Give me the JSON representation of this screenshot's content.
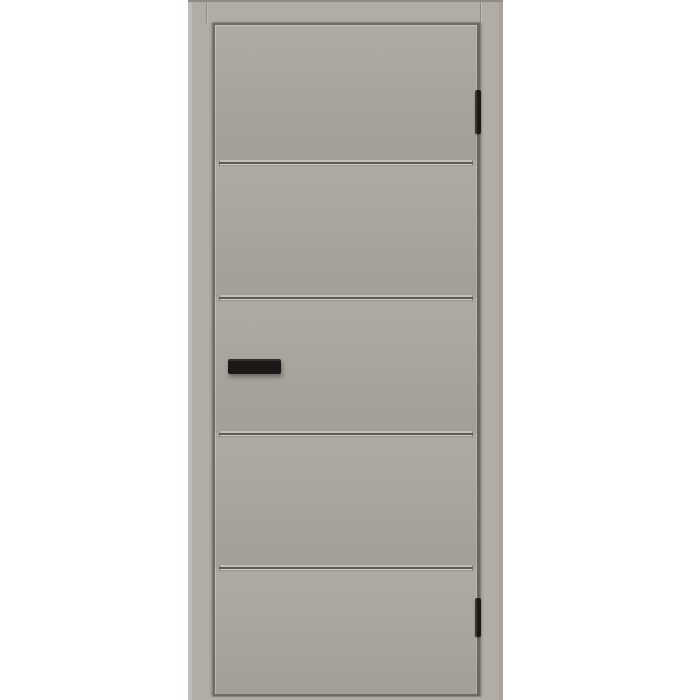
{
  "scene": {
    "description": "Product image of a gray interior door with frame, five flat panels separated by four horizontal grooves, black bar handle on the left stile and two black hinges on the right edge",
    "background_color": "#ffffff"
  },
  "door": {
    "panel_count": 5,
    "groove_count": 4,
    "hinge_count": 2,
    "handle_side": "left",
    "hinge_side": "right",
    "colors": {
      "background": "#ffffff",
      "frame": "#b2aca6",
      "frame_edge_dark": "#8f8a83",
      "frame_highlight": "#c1bbb5",
      "frame_outer_shade": "#a8a29c",
      "reveal": "#a49e98",
      "leaf": "#aba59f",
      "leaf_edge": "#6f6a64",
      "groove_dark": "#5e5954",
      "groove_light": "#c3bdb7",
      "hardware": "#1b1918"
    }
  }
}
